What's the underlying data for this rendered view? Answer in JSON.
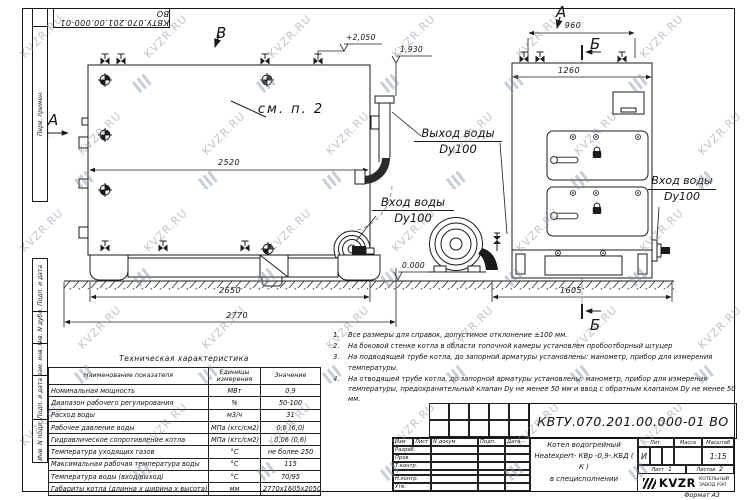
{
  "watermark": {
    "text": "KVZR.RU"
  },
  "doc": {
    "number": "КВТУ.070.201.00.000-01 ВО",
    "format_label": "Формат  А3"
  },
  "sidebar": {
    "items": [
      "Перв. примен.",
      "Подп. и дата",
      "Инв. N дубл.",
      "Взам. инв. N",
      "Подп. и дата",
      "Инв. N подл."
    ]
  },
  "drawing": {
    "view_labels": {
      "a_left": "А",
      "a_top": "А",
      "b_top": "Б",
      "b_bottom": "Б",
      "v_top": "В"
    },
    "callouts": {
      "see_note": "см. п. 2",
      "outlet_line1": "Выход воды",
      "outlet_line2": "Dy100",
      "inlet_left_line1": "Вход воды",
      "inlet_left_line2": "Dy100",
      "inlet_right_line1": "Вход воды",
      "inlet_right_line2": "Dy100"
    },
    "dimensions": {
      "body_length": "2520",
      "base_length": "2650",
      "overall_length": "2770",
      "top_span": "960",
      "front_width": "1260",
      "front_overall": "1605"
    },
    "levels": {
      "top": "+2,050",
      "flue": "1,930",
      "ground": "0.000"
    }
  },
  "spec_table": {
    "title": "Техническая характеристика",
    "headers": [
      "Наименование показателя",
      "Единицы измерения",
      "Значение"
    ],
    "rows": [
      [
        "Номинальная мощность",
        "МВт",
        "0,9"
      ],
      [
        "Диапазон рабочего регулирования",
        "%",
        "50-100"
      ],
      [
        "Расход воды",
        "м3/ч",
        "31"
      ],
      [
        "Рабочее давление воды",
        "МПа (кгс/см2)",
        "0,6 (6,0)"
      ],
      [
        "Гидравлическое сопротивление котла",
        "МПа (кгс/см2)",
        "0,06 (0,6)"
      ],
      [
        "Температура уходящих газов",
        "°С",
        "не более 250"
      ],
      [
        "Максимальная рабочая температура воды",
        "°С",
        "115"
      ],
      [
        "Температура воды (вход/выход)",
        "°С",
        "70/95"
      ],
      [
        "Габариты котла (длинна х ширина х высота)",
        "мм",
        "2770х1605х2050"
      ]
    ]
  },
  "notes": {
    "items": [
      {
        "num": "1.",
        "text": "Все размеры для справок, допустимое отклонение ±100 мм."
      },
      {
        "num": "2.",
        "text": "На боковой стенке котла в области топочной камеры установлен пробоотборный штуцер"
      },
      {
        "num": "3.",
        "text": "На  подводящей трубе котла, до запорной арматуры установлены: манометр, прибор для измерения температуры."
      },
      {
        "num": "4.",
        "text": "На отводящей трубе котла, до запорной арматуры установлены: манометр, прибор для измерения температуры, предохранительный клапан Dу не менее 50 мм и ввод с обратным клапаном Dу не менее 50 мм."
      }
    ]
  },
  "title_block": {
    "rev_headers": [
      "Изм",
      "Лист",
      "N докум.",
      "Подп.",
      "Дата"
    ],
    "sig_rows": [
      "Разраб.",
      "Пров.",
      "Т.контр.",
      "",
      "Н.контр.",
      "Утв."
    ],
    "product_line1": "Котел водогрейный",
    "product_line2": "Heatexpert- КВр -0,9-.КБД ( К )",
    "product_line3": "в специсполнении",
    "lit_label": "Лит.",
    "lit_value": "И",
    "mass_label": "Масса",
    "scale_label": "Масштаб",
    "scale_value": "1:15",
    "sheet_label": "Лист",
    "sheet_value": "1",
    "sheets_label": "Листов",
    "sheets_value": "2",
    "logo_text": "KVZR",
    "company_line1": "КОТЕЛЬНЫЙ",
    "company_line2": "ЗАВОД РЭП"
  }
}
